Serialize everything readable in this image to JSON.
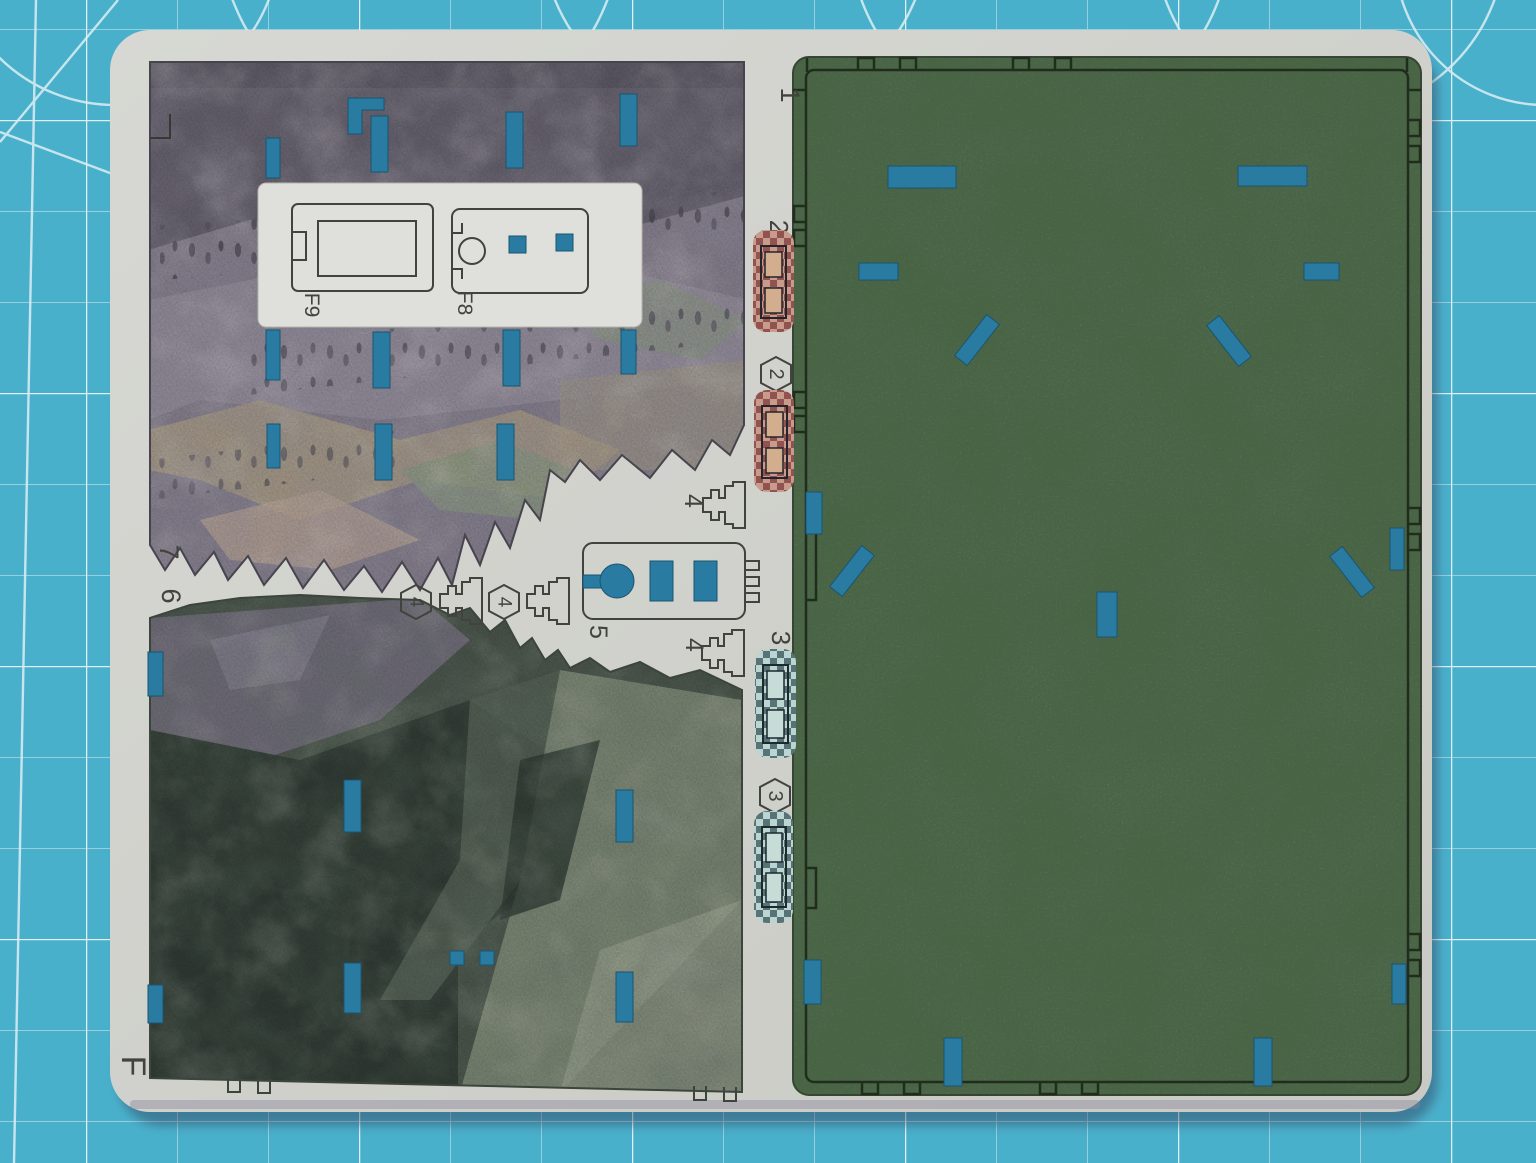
{
  "sheet": {
    "id": "F"
  },
  "labels": {
    "board": "1",
    "red_strip": "2",
    "teal_strip": "3",
    "clip": "4",
    "connector": "5",
    "mountain_lower": "6",
    "mountain_upper": "7",
    "part_f8": "F8",
    "part_f9": "F9"
  },
  "badges": {
    "red_strip": "2",
    "teal_strip": "3",
    "clip": "4"
  },
  "colors": {
    "mat": "#4db6d3",
    "mat_grid": "#eaf7fb",
    "sheet": "#dad9d4",
    "cut_hole": "#2c7ea6",
    "board_green": "#4e6b48",
    "board_border": "#222c1c",
    "mountain_upper_base": "#8d8494",
    "mountain_upper_dark": "#6b6472",
    "mountain_lower_base": "#4e584d",
    "mountain_lower_dark": "#333d35",
    "strip_red_bg": "#d0a18f",
    "strip_red_dark": "#873a41",
    "strip_teal_bg": "#c3ddd7",
    "strip_teal_dark": "#2e4a52",
    "outline": "#3b3a35",
    "label_ink": "#45443f"
  }
}
